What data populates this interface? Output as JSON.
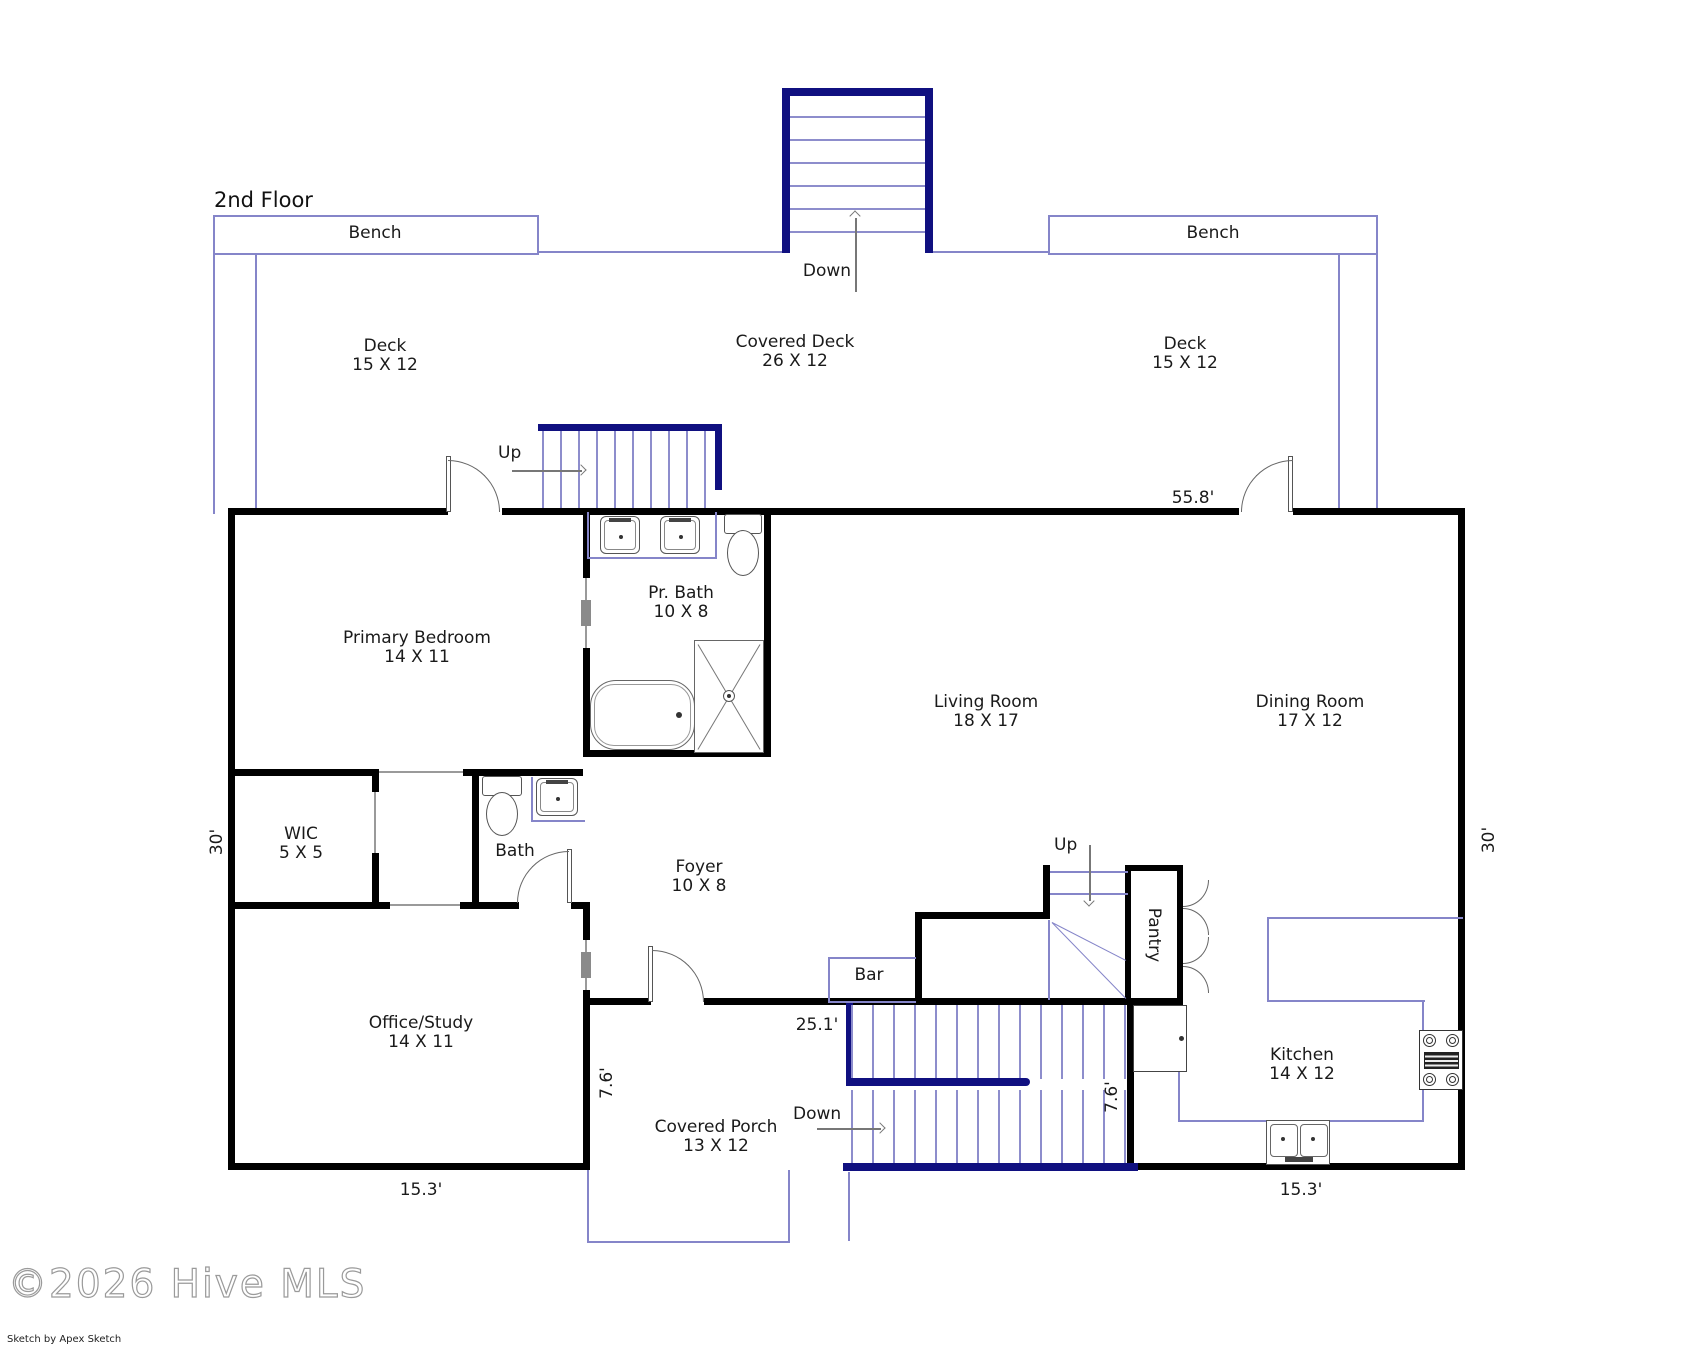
{
  "floor_title": "2nd Floor",
  "labels": {
    "primary_bedroom": {
      "name": "Primary Bedroom",
      "dims": "14 X 11"
    },
    "pr_bath": {
      "name": "Pr. Bath",
      "dims": "10 X 8"
    },
    "wic": {
      "name": "WIC",
      "dims": "5 X 5"
    },
    "bath": {
      "name": "Bath"
    },
    "foyer": {
      "name": "Foyer",
      "dims": "10 X 8"
    },
    "office_study": {
      "name": "Office/Study",
      "dims": "14 X 11"
    },
    "living_room": {
      "name": "Living Room",
      "dims": "18 X 17"
    },
    "dining_room": {
      "name": "Dining Room",
      "dims": "17 X 12"
    },
    "kitchen": {
      "name": "Kitchen",
      "dims": "14 X 12"
    },
    "pantry": {
      "name": "Pantry"
    },
    "bar": {
      "name": "Bar"
    },
    "covered_porch": {
      "name": "Covered Porch",
      "dims": "13 X 12"
    },
    "deck_left": {
      "name": "Deck",
      "dims": "15 X 12"
    },
    "covered_deck": {
      "name": "Covered Deck",
      "dims": "26 X 12"
    },
    "deck_right": {
      "name": "Deck",
      "dims": "15 X 12"
    },
    "bench_left": {
      "name": "Bench"
    },
    "bench_right": {
      "name": "Bench"
    }
  },
  "dimensions": {
    "top_width": "55.8'",
    "left_height": "30'",
    "right_height": "30'",
    "porch_width": "25.1'",
    "bottom_left_width": "15.3'",
    "bottom_right_width": "15.3'",
    "porch_height": "7.6'",
    "kitchen_height": "7.6'"
  },
  "stairs": {
    "deck_down": "Down",
    "deck_up": "Up",
    "interior_up": "Up",
    "porch_down": "Down"
  },
  "watermark": {
    "text": "©2026 Hive MLS",
    "credit": "Sketch by Apex Sketch"
  },
  "colors": {
    "wall": "#000000",
    "stair_rail": "#101080",
    "deck_line": "#8585c9",
    "fixture": "#555555",
    "text": "#1a1a1a"
  },
  "fixtures": [
    "double-vanity-sink",
    "toilet",
    "bathtub",
    "shower",
    "sink",
    "kitchen-double-sink",
    "stove",
    "refrigerator",
    "pantry-bifold-doors",
    "bench"
  ]
}
